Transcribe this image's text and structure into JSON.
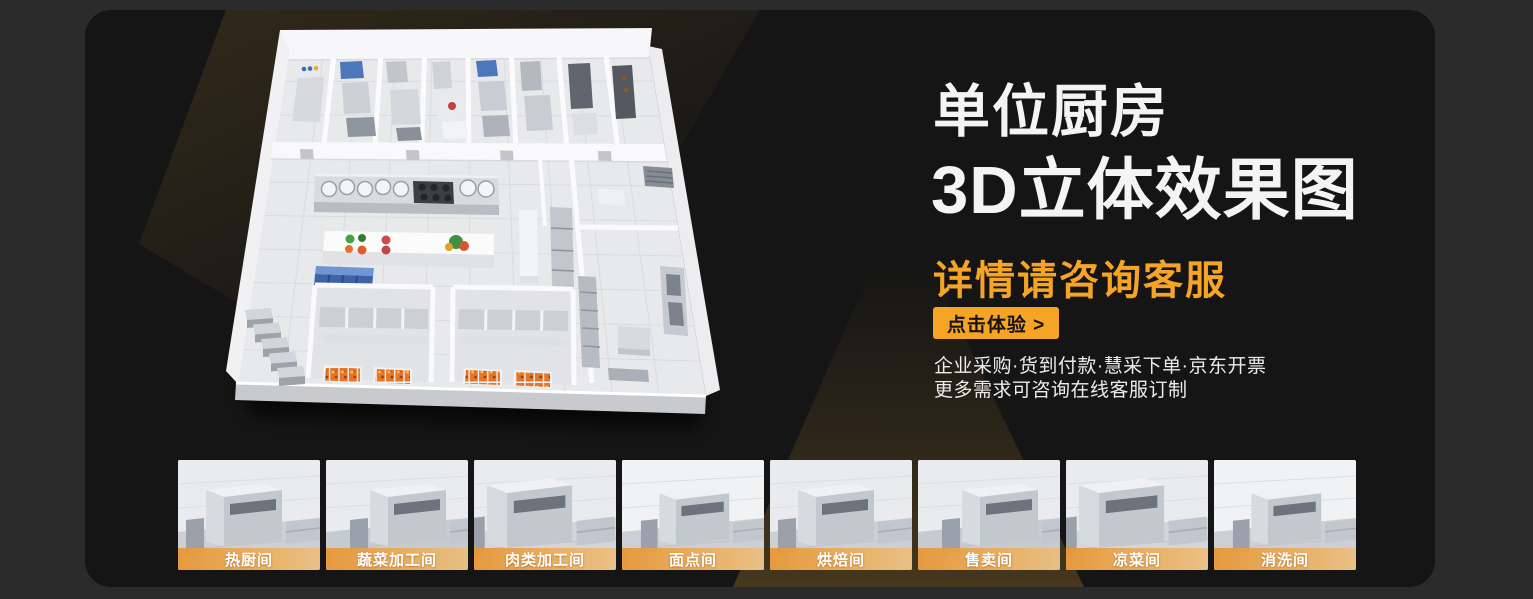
{
  "colors": {
    "background": "#2b2b2b",
    "panel_background": "#151515",
    "accent_orange": "#F5A425",
    "banner_orange": "#E8993A",
    "title_white": "#F4F4F4"
  },
  "hero": {
    "title_line1": "单位厨房",
    "title_line2": "3D立体效果图",
    "subtitle": "详情请咨询客服",
    "cta_label": "点击体验 >",
    "info_line1": "企业采购·货到付款·慧采下单·京东开票",
    "info_line2": "更多需求可咨询在线客服订制"
  },
  "rooms": [
    {
      "label": "热厨间"
    },
    {
      "label": "蔬菜加工间"
    },
    {
      "label": "肉类加工间"
    },
    {
      "label": "面点间"
    },
    {
      "label": "烘焙间"
    },
    {
      "label": "售卖间"
    },
    {
      "label": "凉菜间"
    },
    {
      "label": "消洗间"
    }
  ]
}
